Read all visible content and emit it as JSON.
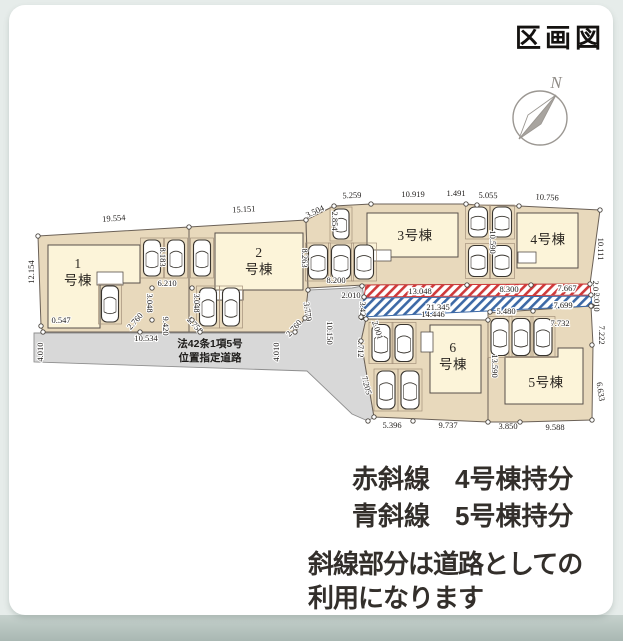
{
  "page": {
    "title": "区画図"
  },
  "legend": {
    "red_label": "赤斜線",
    "red_value": "4号棟持分",
    "blue_label": "青斜線",
    "blue_value": "5号棟持分",
    "note1": "斜線部分は道路としての",
    "note2": "利用になります"
  },
  "compass": {
    "label": "N",
    "cx": 540,
    "cy": 118,
    "r": 27,
    "needle_light": "556,95 528,115 519,139",
    "needle_dark": "556,95 541,124 519,139",
    "label_x": 556,
    "label_y": 88
  },
  "colors": {
    "parcel": "#e8d9bc",
    "house": "#fcf4d9",
    "road": "#d8d8d8",
    "road_stroke": "#8f8f8f",
    "parcel_stroke": "#6b6157",
    "house_stroke": "#57504a",
    "red": "#cf3a3a",
    "blue": "#3d69a6",
    "dim": "#221f1d",
    "car": "#ffffff",
    "car_stroke": "#39352f",
    "stall_stroke": "#a4917b",
    "dot_stroke": "#4a453f",
    "label_text": "#2b2722",
    "compass_stroke": "#9b9792"
  },
  "plot": {
    "roads": [
      {
        "name": "road-main",
        "points": "34,333 295,333 305,318 308,290 352,288 362,286 364,297 361,317 366,319 361,341 374,417 368,421 352,414 307,371 34,362"
      },
      {
        "name": "road-notch",
        "points": "152,288 192,288 192,320 200,332 144,332 152,320"
      }
    ],
    "parcels": [
      {
        "name": "lot-1",
        "points": "38,236 189,227 189,332 43,332 41,326"
      },
      {
        "name": "lot-2",
        "points": "189,227 306,220 308,290 305,318 295,332 189,332"
      },
      {
        "name": "lot-3-4",
        "points": "334,206 371,204 466,204 477,205 519,206 600,210 590,284 364,285 308,288 306,220"
      },
      {
        "name": "lot-6",
        "points": "366,319 488,320 488,422 374,417 361,341"
      },
      {
        "name": "lot-5",
        "points": "488,313 591,306 593,345 592,420 520,422 488,422"
      }
    ],
    "strips": [
      {
        "name": "red-hatch-strip",
        "hatch": "red",
        "points": "366,285 590,284 591,295 364,297",
        "labels": [
          {
            "t": "13.048",
            "x": 420,
            "y": 294
          },
          {
            "t": "8.300",
            "x": 509,
            "y": 292
          },
          {
            "t": "7.667",
            "x": 567,
            "y": 291
          }
        ]
      },
      {
        "name": "blue-hatch-strip",
        "hatch": "blue",
        "points": "364,298 591,296 592,306 361,317",
        "labels": [
          {
            "t": "21.345",
            "x": 438,
            "y": 310
          },
          {
            "t": "5.480",
            "x": 506,
            "y": 314
          },
          {
            "t": "7.699",
            "x": 563,
            "y": 308
          }
        ]
      }
    ],
    "houses": [
      {
        "name": "house-1",
        "points": "48,245 140,245 140,283 100,283 100,328 48,328",
        "label": [
          "1",
          "号棟"
        ],
        "lx": 78,
        "ly": 268
      },
      {
        "name": "house-2",
        "points": "215,233 303,233 303,290 243,290 243,300 215,300",
        "label": [
          "2",
          "号棟"
        ],
        "lx": 259,
        "ly": 257
      },
      {
        "name": "house-3",
        "points": "367,213 458,213 458,257 367,257",
        "label": [
          "3号棟"
        ],
        "lx": 415,
        "ly": 240
      },
      {
        "name": "house-4",
        "points": "517,213 578,213 578,268 517,268",
        "label": [
          "4号棟"
        ],
        "lx": 548,
        "ly": 244
      },
      {
        "name": "house-5",
        "points": "505,357 558,357 558,348 583,348 583,404 505,404",
        "label": [
          "5号棟"
        ],
        "lx": 546,
        "ly": 387
      },
      {
        "name": "house-6",
        "points": "430,325 481,325 481,393 430,393",
        "label": [
          "6",
          "号棟"
        ],
        "lx": 453,
        "ly": 352
      }
    ],
    "porches": [
      [
        97,
        272,
        26,
        13
      ],
      [
        216,
        290,
        27,
        10
      ],
      [
        367,
        250,
        24,
        11
      ],
      [
        518,
        252,
        18,
        11
      ],
      [
        421,
        332,
        12,
        20
      ]
    ],
    "cars": [
      [
        152,
        258,
        17,
        36
      ],
      [
        176,
        258,
        17,
        36
      ],
      [
        110,
        304,
        17,
        36
      ],
      [
        202,
        258,
        17,
        36
      ],
      [
        208,
        307,
        17,
        38
      ],
      [
        231,
        307,
        17,
        38
      ],
      [
        341,
        224,
        16,
        30
      ],
      [
        318,
        262,
        19,
        34
      ],
      [
        341,
        262,
        19,
        34
      ],
      [
        364,
        262,
        19,
        34
      ],
      [
        478,
        222,
        19,
        30
      ],
      [
        502,
        222,
        19,
        30
      ],
      [
        478,
        261,
        19,
        31
      ],
      [
        502,
        261,
        19,
        31
      ],
      [
        381,
        343,
        18,
        37
      ],
      [
        404,
        343,
        18,
        37
      ],
      [
        386,
        390,
        18,
        38
      ],
      [
        410,
        390,
        18,
        38
      ],
      [
        500,
        337,
        18,
        37
      ],
      [
        521,
        337,
        18,
        37
      ],
      [
        543,
        337,
        18,
        37
      ]
    ],
    "dims": [
      {
        "t": "19.554",
        "x": 114,
        "y": 221,
        "r": -4
      },
      {
        "t": "15.151",
        "x": 244,
        "y": 212,
        "r": -3
      },
      {
        "t": "3.504",
        "x": 316,
        "y": 214,
        "r": -25
      },
      {
        "t": "5.259",
        "x": 352,
        "y": 198,
        "r": -2
      },
      {
        "t": "10.919",
        "x": 413,
        "y": 197,
        "r": 0
      },
      {
        "t": "1.491",
        "x": 456,
        "y": 196,
        "r": 0
      },
      {
        "t": "5.055",
        "x": 488,
        "y": 198,
        "r": 1
      },
      {
        "t": "10.756",
        "x": 547,
        "y": 200,
        "r": 3
      },
      {
        "t": "12.154",
        "x": 34,
        "y": 272,
        "r": -90
      },
      {
        "t": "0.547",
        "x": 61,
        "y": 323,
        "r": 0
      },
      {
        "t": "10.534",
        "x": 146,
        "y": 341,
        "r": 0
      },
      {
        "t": "4.010",
        "x": 43,
        "y": 352,
        "r": -90
      },
      {
        "t": "4.010",
        "x": 279,
        "y": 352,
        "r": -90
      },
      {
        "t": "6.210",
        "x": 167,
        "y": 286,
        "r": 0
      },
      {
        "t": "3.048",
        "x": 147,
        "y": 303,
        "r": 90
      },
      {
        "t": "3.048",
        "x": 194,
        "y": 303,
        "r": 90
      },
      {
        "t": "9.420",
        "x": 163,
        "y": 326,
        "r": 90
      },
      {
        "t": "2.760",
        "x": 137,
        "y": 323,
        "r": -48
      },
      {
        "t": "2.758",
        "x": 193,
        "y": 327,
        "r": 48
      },
      {
        "t": "8.183",
        "x": 160,
        "y": 257,
        "r": 90
      },
      {
        "t": "8.263",
        "x": 302,
        "y": 258,
        "r": 90
      },
      {
        "t": "2.854",
        "x": 332,
        "y": 221,
        "r": 90
      },
      {
        "t": "8.200",
        "x": 336,
        "y": 283,
        "r": 0
      },
      {
        "t": "3.779",
        "x": 305,
        "y": 312,
        "r": 82
      },
      {
        "t": "2.760",
        "x": 296,
        "y": 330,
        "r": -48
      },
      {
        "t": "10.150",
        "x": 327,
        "y": 333,
        "r": 90
      },
      {
        "t": "2.010",
        "x": 351,
        "y": 298,
        "r": 0
      },
      {
        "t": "3.428",
        "x": 360,
        "y": 311,
        "r": 90
      },
      {
        "t": "4.712",
        "x": 358,
        "y": 348,
        "r": 90
      },
      {
        "t": "2.001",
        "x": 375,
        "y": 331,
        "r": 72
      },
      {
        "t": "10.590",
        "x": 490,
        "y": 242,
        "r": 90
      },
      {
        "t": "10.111",
        "x": 598,
        "y": 249,
        "r": 90
      },
      {
        "t": "2.010",
        "x": 593,
        "y": 290,
        "r": 90
      },
      {
        "t": "2.010",
        "x": 594,
        "y": 302,
        "r": 90
      },
      {
        "t": "7.222",
        "x": 599,
        "y": 335,
        "r": 90
      },
      {
        "t": "6.633",
        "x": 598,
        "y": 392,
        "r": 82
      },
      {
        "t": "14.446",
        "x": 433,
        "y": 317,
        "r": 0
      },
      {
        "t": "7.732",
        "x": 560,
        "y": 326,
        "r": 0
      },
      {
        "t": "13.590",
        "x": 492,
        "y": 366,
        "r": 90
      },
      {
        "t": "7.205",
        "x": 364,
        "y": 386,
        "r": 75
      },
      {
        "t": "5.396",
        "x": 392,
        "y": 428,
        "r": 0
      },
      {
        "t": "9.737",
        "x": 448,
        "y": 428,
        "r": 0
      },
      {
        "t": "3.850",
        "x": 508,
        "y": 429,
        "r": 0
      },
      {
        "t": "9.588",
        "x": 555,
        "y": 430,
        "r": 0
      }
    ],
    "road_label": {
      "lines": [
        "法42条1項5号",
        "位置指定道路"
      ],
      "x": 210,
      "y": 347,
      "line_height": 14
    },
    "dots": [
      [
        38,
        236
      ],
      [
        189,
        227
      ],
      [
        306,
        220
      ],
      [
        334,
        206
      ],
      [
        371,
        204
      ],
      [
        466,
        204
      ],
      [
        477,
        205
      ],
      [
        519,
        206
      ],
      [
        600,
        210
      ],
      [
        590,
        284
      ],
      [
        591,
        295
      ],
      [
        592,
        306
      ],
      [
        592,
        345
      ],
      [
        592,
        420
      ],
      [
        520,
        422
      ],
      [
        488,
        422
      ],
      [
        413,
        421
      ],
      [
        374,
        417
      ],
      [
        368,
        421
      ],
      [
        43,
        332
      ],
      [
        41,
        326
      ],
      [
        140,
        332
      ],
      [
        152,
        320
      ],
      [
        152,
        288
      ],
      [
        192,
        288
      ],
      [
        192,
        320
      ],
      [
        200,
        332
      ],
      [
        295,
        332
      ],
      [
        305,
        318
      ],
      [
        308,
        290
      ],
      [
        362,
        286
      ],
      [
        366,
        319
      ],
      [
        361,
        341
      ],
      [
        488,
        320
      ],
      [
        591,
        306
      ],
      [
        467,
        285
      ],
      [
        531,
        285
      ],
      [
        490,
        312
      ],
      [
        533,
        311
      ],
      [
        364,
        297
      ],
      [
        361,
        317
      ]
    ]
  }
}
